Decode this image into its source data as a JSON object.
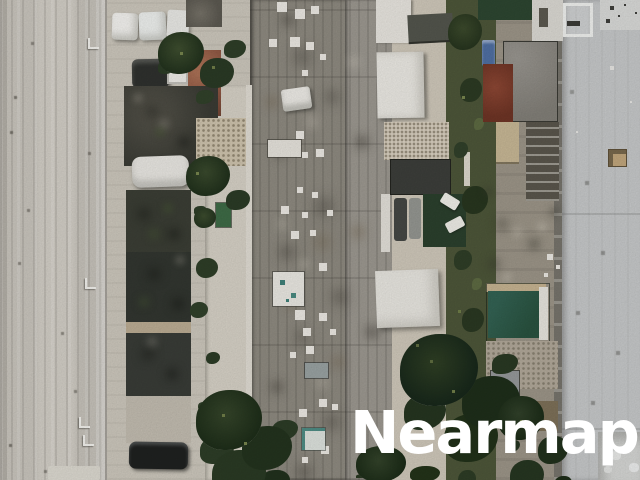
{
  "watermark": {
    "text": "Nearmap",
    "color": "#ffffff"
  },
  "imagery": {
    "type": "aerial-orthophoto",
    "features": [
      "asphalt-road-with-parking-markings",
      "rowhouse-carport-roofs",
      "parked-cars",
      "palm-trees-and-backyard-vegetation",
      "central-apartment-roof-with-ac-units",
      "white-flat-roofs",
      "red-roof",
      "green-pool-canopy",
      "patio-and-shed",
      "large-light-gray-warehouse-roof"
    ]
  },
  "palette": {
    "road": "#c9c5bd",
    "concrete": "#d6d1c6",
    "dark_roof": "#3b3e35",
    "weathered_roof": "#8e8a80",
    "white_roof": "#ebe9e3",
    "red_roof": "#7e3d2d",
    "green_canopy": "#2d5b49",
    "vegetation": "#2c3a23",
    "light_building": "#c6c8c9",
    "watermark": "#ffffff"
  }
}
